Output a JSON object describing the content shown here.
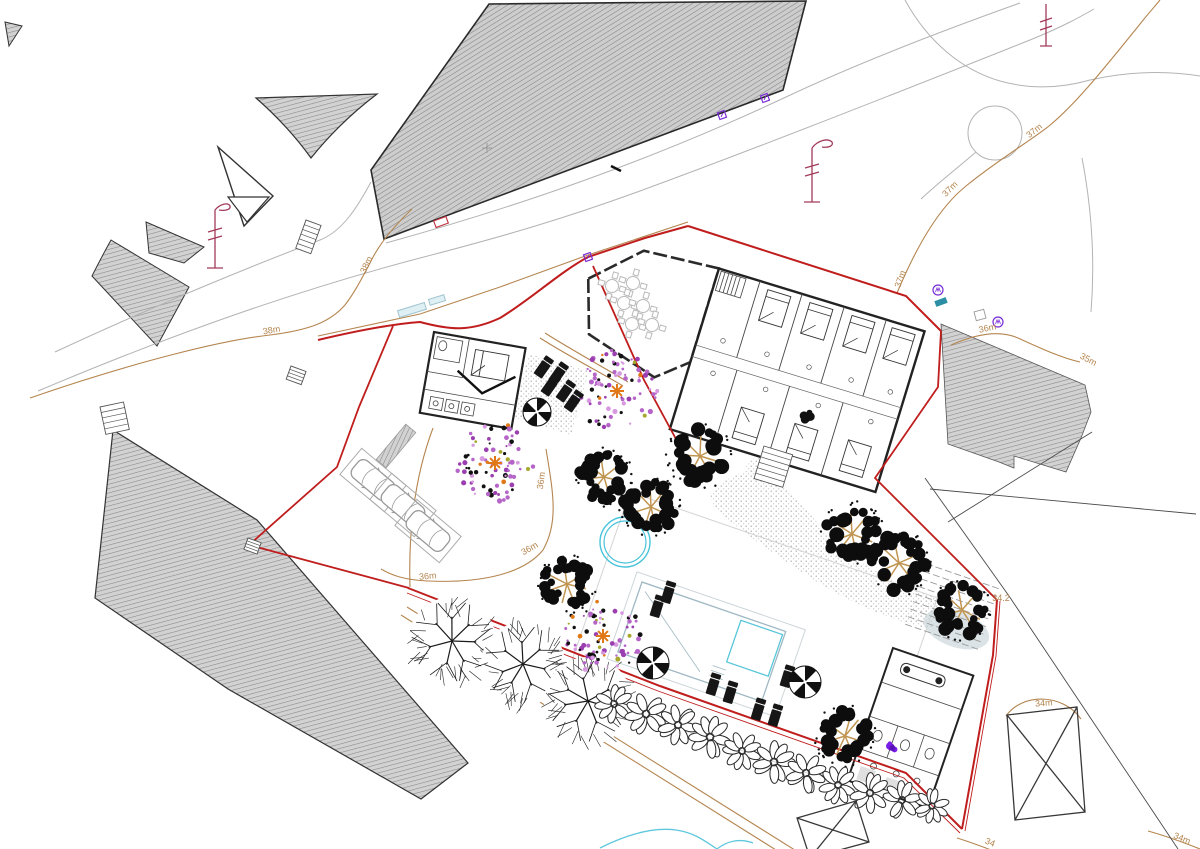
{
  "meta": {
    "drawing_type": "architectural-site-plan",
    "canvas_width": 1200,
    "canvas_height": 849
  },
  "colors": {
    "boundary_red": "#c01d1d",
    "contour_tan": "#b5854f",
    "road_gray": "#b3b3b3",
    "hatch_fill": "#cdcdcd",
    "hatch_line": "#848484",
    "pool_cyan": "#49c3da",
    "pool_edge": "#9fb8c2",
    "marker_purple": "#7a2bd6",
    "survey_maroon": "#a23b5a",
    "flower_violet": "#7a1fe8",
    "tree_branch_tan": "#c09552",
    "flower_pink": "#b565c8",
    "flower_orange": "#e07818",
    "car_gray": "#9a9a9a",
    "teal": "#2d8fa5",
    "stream_blue": "#5fc8de"
  },
  "contour_labels": [
    {
      "text": "38m",
      "x": 272,
      "y": 333,
      "rot": -10
    },
    {
      "text": "38m",
      "x": 369,
      "y": 266,
      "rot": -65
    },
    {
      "text": "37m",
      "x": 903,
      "y": 280,
      "rot": -70
    },
    {
      "text": "37m",
      "x": 952,
      "y": 191,
      "rot": -45
    },
    {
      "text": "37m",
      "x": 1036,
      "y": 133,
      "rot": -38
    },
    {
      "text": "36m",
      "x": 988,
      "y": 331,
      "rot": -12
    },
    {
      "text": "36m",
      "x": 544,
      "y": 481,
      "rot": -82
    },
    {
      "text": "36m",
      "x": 531,
      "y": 551,
      "rot": -30
    },
    {
      "text": "36m",
      "x": 428,
      "y": 579,
      "rot": -5
    },
    {
      "text": "35m",
      "x": 1087,
      "y": 362,
      "rot": 28
    },
    {
      "text": "34m",
      "x": 1044,
      "y": 706,
      "rot": -4
    },
    {
      "text": "34m",
      "x": 1181,
      "y": 841,
      "rot": 22
    },
    {
      "text": "34",
      "x": 989,
      "y": 845,
      "rot": 22
    }
  ],
  "spot_levels": [
    {
      "text": "34.2",
      "x": 1001,
      "y": 601,
      "rot": 0
    }
  ],
  "trees": {
    "dense": [
      {
        "x": 700,
        "y": 456,
        "r": 30
      },
      {
        "x": 852,
        "y": 534,
        "r": 29
      },
      {
        "x": 899,
        "y": 563,
        "r": 29
      },
      {
        "x": 962,
        "y": 610,
        "r": 27
      },
      {
        "x": 845,
        "y": 736,
        "r": 28
      },
      {
        "x": 567,
        "y": 584,
        "r": 26
      },
      {
        "x": 651,
        "y": 507,
        "r": 28
      },
      {
        "x": 604,
        "y": 477,
        "r": 26
      }
    ],
    "outline": [
      {
        "x": 452,
        "y": 641,
        "r": 44
      },
      {
        "x": 523,
        "y": 664,
        "r": 42
      },
      {
        "x": 588,
        "y": 701,
        "r": 44
      }
    ],
    "flowering": [
      {
        "x": 495,
        "y": 463,
        "r": 40
      },
      {
        "x": 617,
        "y": 391,
        "r": 42
      },
      {
        "x": 603,
        "y": 636,
        "r": 38
      }
    ]
  },
  "hedge": [
    {
      "x": 614,
      "y": 704,
      "r": 20
    },
    {
      "x": 646,
      "y": 714,
      "r": 22
    },
    {
      "x": 678,
      "y": 725,
      "r": 21
    },
    {
      "x": 710,
      "y": 737,
      "r": 22
    },
    {
      "x": 742,
      "y": 751,
      "r": 20
    },
    {
      "x": 774,
      "y": 762,
      "r": 22
    },
    {
      "x": 806,
      "y": 773,
      "r": 21
    },
    {
      "x": 838,
      "y": 785,
      "r": 20
    },
    {
      "x": 870,
      "y": 793,
      "r": 21
    },
    {
      "x": 902,
      "y": 800,
      "r": 20
    },
    {
      "x": 932,
      "y": 806,
      "r": 18
    }
  ],
  "furniture": {
    "loungers": [
      {
        "x": 667,
        "y": 597,
        "rot": 17
      },
      {
        "x": 656,
        "y": 611,
        "rot": 17
      },
      {
        "x": 712,
        "y": 689,
        "rot": 17
      },
      {
        "x": 729,
        "y": 697,
        "rot": 17
      },
      {
        "x": 757,
        "y": 714,
        "rot": 17
      },
      {
        "x": 774,
        "y": 720,
        "rot": 17
      },
      {
        "x": 786,
        "y": 681,
        "rot": 17
      },
      {
        "x": 541,
        "y": 371,
        "rot": 35
      },
      {
        "x": 556,
        "y": 377,
        "rot": 35
      },
      {
        "x": 548,
        "y": 389,
        "rot": 35
      },
      {
        "x": 563,
        "y": 395,
        "rot": 35
      },
      {
        "x": 571,
        "y": 405,
        "rot": 35
      }
    ],
    "parasols": [
      {
        "x": 653,
        "y": 663,
        "r": 16
      },
      {
        "x": 805,
        "y": 682,
        "r": 16
      },
      {
        "x": 537,
        "y": 412,
        "r": 14
      }
    ],
    "terrace_tables": [
      {
        "x": 612,
        "y": 286
      },
      {
        "x": 633,
        "y": 283
      },
      {
        "x": 624,
        "y": 303
      },
      {
        "x": 643,
        "y": 306
      },
      {
        "x": 632,
        "y": 324
      },
      {
        "x": 652,
        "y": 325
      }
    ]
  },
  "parking": {
    "bays": [
      {
        "x": 373,
        "y": 480,
        "rot": -50
      },
      {
        "x": 403,
        "y": 505,
        "rot": -50
      },
      {
        "x": 428,
        "y": 531,
        "rot": -50
      }
    ],
    "strip": {
      "x": 396,
      "y": 446,
      "rot": -50,
      "w": 46,
      "h": 13
    }
  },
  "building": {
    "top_beds": [
      190,
      234,
      278,
      320
    ],
    "bottom_beds": [
      199,
      255,
      311
    ]
  },
  "markers": {
    "purple_squares": [
      {
        "x": 722,
        "y": 115
      },
      {
        "x": 765,
        "y": 98
      },
      {
        "x": 588,
        "y": 257
      }
    ],
    "purple_circles": [
      {
        "x": 938,
        "y": 290
      },
      {
        "x": 998,
        "y": 322
      }
    ],
    "teal_rects": [
      {
        "x": 941,
        "y": 302,
        "rot": -20
      }
    ],
    "red_rects": [
      {
        "x": 441,
        "y": 222,
        "rot": -20
      }
    ],
    "blue_benches": [
      {
        "x": 412,
        "y": 310,
        "w": 28,
        "h": 7,
        "rot": -17
      },
      {
        "x": 437,
        "y": 300,
        "w": 16,
        "h": 6,
        "rot": -17
      }
    ],
    "violet_flowers": [
      {
        "x": 891,
        "y": 747
      }
    ],
    "gray_crosses": [
      {
        "x": 487,
        "y": 148
      }
    ],
    "black_ticks": [
      {
        "x": 616,
        "y": 168
      }
    ],
    "tiny_squares": [
      {
        "x": 980,
        "y": 315,
        "rot": -15
      }
    ]
  },
  "stairs": [
    {
      "x": 306,
      "y": 220,
      "w": 16,
      "h": 30,
      "n": 6,
      "rot": 20
    },
    {
      "x": 100,
      "y": 407,
      "w": 24,
      "h": 28,
      "n": 5,
      "rot": -12
    },
    {
      "x": 291,
      "y": 366,
      "w": 16,
      "h": 14,
      "n": 4,
      "rot": 20
    },
    {
      "x": 248,
      "y": 538,
      "w": 14,
      "h": 12,
      "n": 4,
      "rot": 20
    },
    {
      "x": 764,
      "y": 446,
      "w": 30,
      "h": 34,
      "n": 6,
      "rot": 17
    }
  ],
  "x_structures": [
    {
      "points": [
        [
          1007,
          715
        ],
        [
          1077,
          707
        ],
        [
          1085,
          812
        ],
        [
          1015,
          820
        ]
      ]
    },
    {
      "points": [
        [
          797,
          818
        ],
        [
          856,
          801
        ],
        [
          869,
          842
        ],
        [
          810,
          858
        ]
      ]
    }
  ]
}
